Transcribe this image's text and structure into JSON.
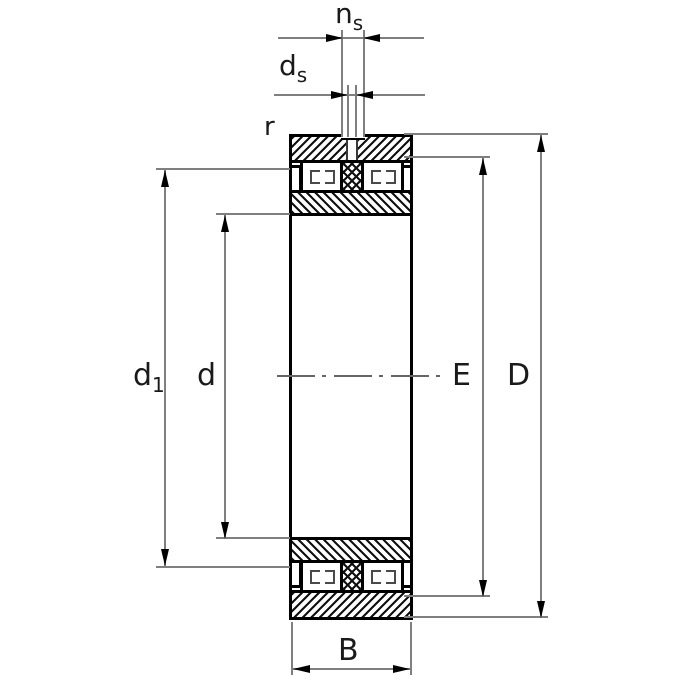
{
  "figure": {
    "labels": {
      "lubrication_groove_width": {
        "base": "n",
        "sub": "s"
      },
      "lubrication_hole_diameter": {
        "base": "d",
        "sub": "s"
      },
      "chamfer_radius": "r",
      "inner_rib_diameter": {
        "base": "d",
        "sub": "1"
      },
      "bore_diameter": "d",
      "outer_raceway_diameter": "E",
      "outside_diameter": "D",
      "width": "B"
    },
    "colors": {
      "outline": "#000000",
      "dimension_lines": "#7f7f7f",
      "label_text": "#1a1a1a",
      "background": "#ffffff"
    }
  }
}
